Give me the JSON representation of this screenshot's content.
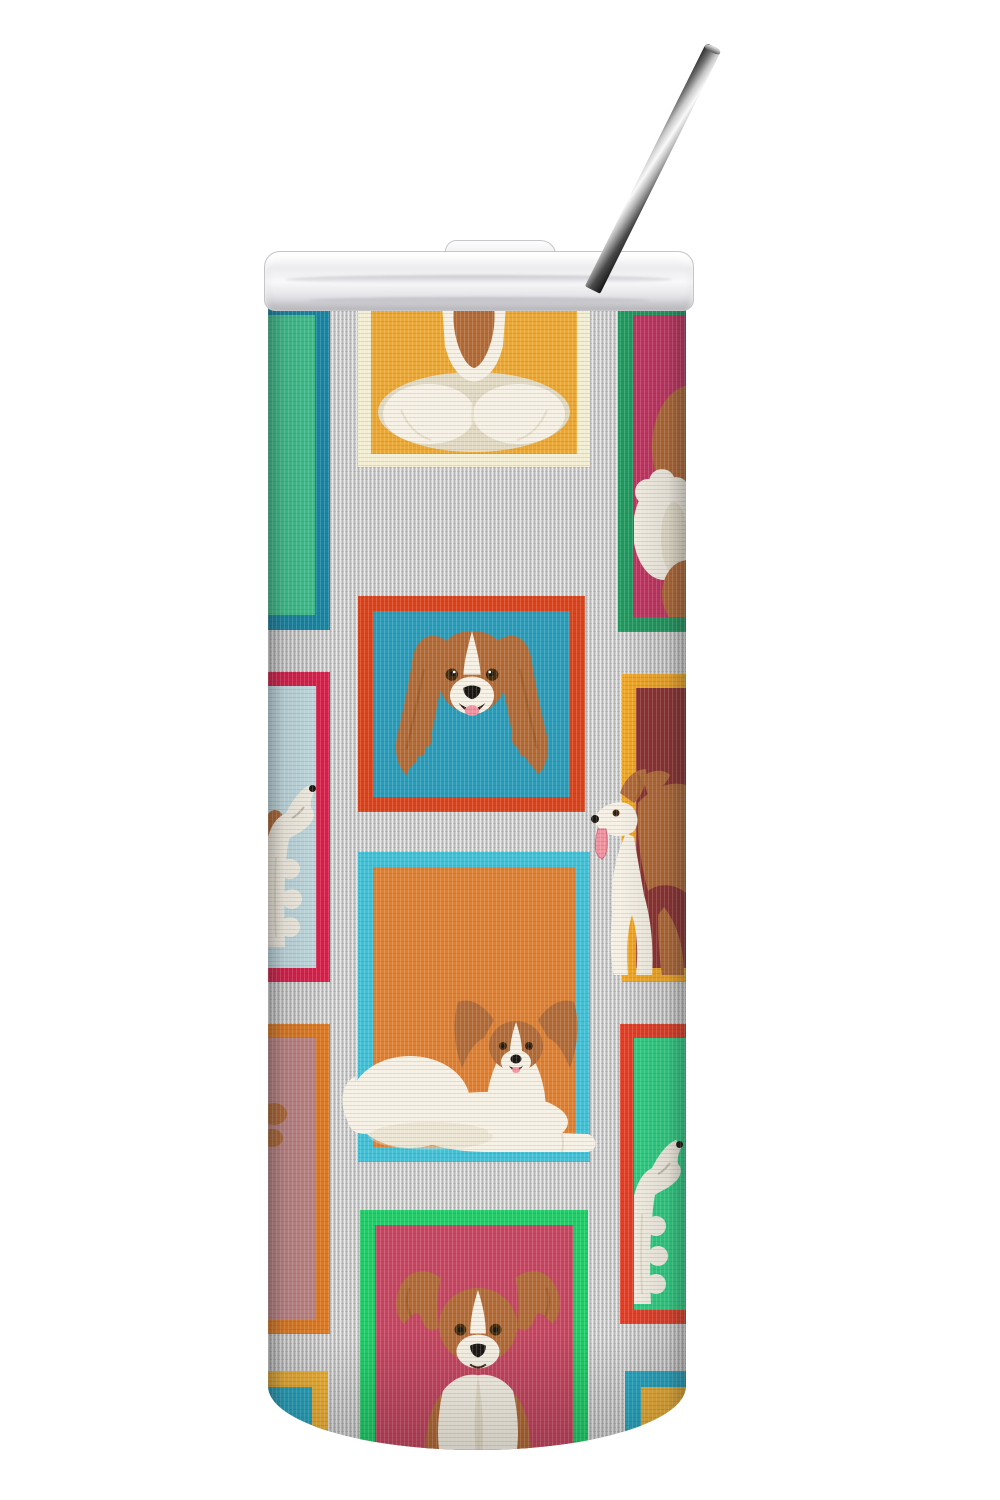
{
  "scene": {
    "type": "product-photo",
    "description": "Stainless steel skinny tumbler with clear sliding lid and stainless straw, printed with Papillon dog picture frames on gray linen",
    "background": "#ffffff"
  },
  "palette": {
    "dog_russet": "#b26a36",
    "dog_russet_dark": "#96551f",
    "dog_white": "#f6f1e4",
    "dog_cream": "#e2dac2",
    "dog_tongue": "#f2919f",
    "dog_eye": "#472b0c",
    "dog_ink": "#1b1713"
  },
  "lid": {
    "label": "clear plastic sliding lid",
    "color": "#f2f2f5"
  },
  "straw": {
    "label": "stainless steel straw",
    "color_dark": "#2e2e2e",
    "color_light": "#f8f8f8"
  },
  "wrap": {
    "label": "gray linen pattern wrap",
    "gray": "#cfcfcf"
  },
  "frames": [
    {
      "name": "top-left-green",
      "border": "#1886a3",
      "fill": "#3ec28d",
      "dog": "empty panel wrapping edge"
    },
    {
      "name": "top-center-amber",
      "border": "#f3eed2",
      "fill": "#eca832",
      "dog": "papillon head seen from behind"
    },
    {
      "name": "top-right-crimson",
      "border": "#219a5f",
      "fill": "#c23561",
      "dog": "partial papillon at wrap edge"
    },
    {
      "name": "center-teal",
      "border": "#d8431c",
      "fill": "#2a9cb8",
      "dog": "papillon head with long fringed ears"
    },
    {
      "name": "mid-left-sky",
      "border": "#d8204a",
      "fill": "#c2dde2",
      "dog": "white papillon looking up"
    },
    {
      "name": "mid-right-maroon",
      "border": "#f3a722",
      "fill": "#8d3331",
      "dog": "trotting papillon with tongue out"
    },
    {
      "name": "lower-center-orange",
      "border": "#41c1d6",
      "fill": "#dd8033",
      "dog": "red and white papillon lying down"
    },
    {
      "name": "lower-left-mauve",
      "border": "#df7a20",
      "fill": "#bf8584",
      "dog": "paw detail at wrap edge"
    },
    {
      "name": "lower-right-green",
      "border": "#e33e25",
      "fill": "#2fd083",
      "dog": "white papillon looking up"
    },
    {
      "name": "bottom-center-raspberry",
      "border": "#1ecd68",
      "fill": "#c4465f",
      "dog": "papillon sitting front view"
    },
    {
      "name": "bottom-left-corner",
      "border": "#f2b232",
      "fill": "#27a9c4",
      "dog": "none"
    },
    {
      "name": "bottom-right-corner",
      "border": "#27a9c4",
      "fill": "#f2b232",
      "dog": "none"
    }
  ]
}
